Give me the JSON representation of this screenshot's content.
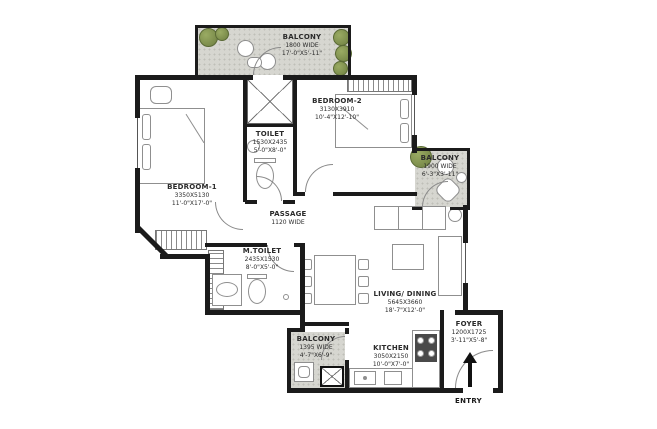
{
  "plan": {
    "rooms": {
      "balcony_top": {
        "name": "BALCONY",
        "line2": "1800 WIDE",
        "line3": "17'-0\"X5'-11\""
      },
      "bedroom2": {
        "name": "BEDROOM-2",
        "line2": "3130X3910",
        "line3": "10'-4\"X12'-10\""
      },
      "toilet": {
        "name": "TOILET",
        "line2": "1530X2435",
        "line3": "5'-0\"X8'-0\""
      },
      "bedroom1": {
        "name": "BEDROOM-1",
        "line2": "3350X5130",
        "line3": "11'-0\"X17'-0\""
      },
      "passage": {
        "name": "PASSAGE",
        "line2": "1120 WIDE"
      },
      "m_toilet": {
        "name": "M.TOILET",
        "line2": "2435X1530",
        "line3": "8'-0\"X5'-0\""
      },
      "balcony_right": {
        "name": "BALCONY",
        "line2": "1900 WIDE",
        "line3": "6'-3\"X3'-11\""
      },
      "living_dining": {
        "name": "LIVING/ DINING",
        "line2": "5645X3660",
        "line3": "18'-7\"X12'-0\""
      },
      "foyer": {
        "name": "FOYER",
        "line2": "1200X1725",
        "line3": "3'-11\"X5'-8\""
      },
      "kitchen": {
        "name": "KITCHEN",
        "line2": "3050X2150",
        "line3": "10'-0\"X7'-0\""
      },
      "balcony_bottom": {
        "name": "BALCONY",
        "line2": "1395 WIDE",
        "line3": "4'-7\"X6'-9\""
      }
    },
    "entry_label": "ENTRY",
    "colors": {
      "wall": "#1b1b1b",
      "balcony_floor": "#d6d6d0",
      "planter_green": "#7f934f",
      "furniture_line": "#8f8f8f",
      "label_text": "#2b2b2b"
    }
  }
}
